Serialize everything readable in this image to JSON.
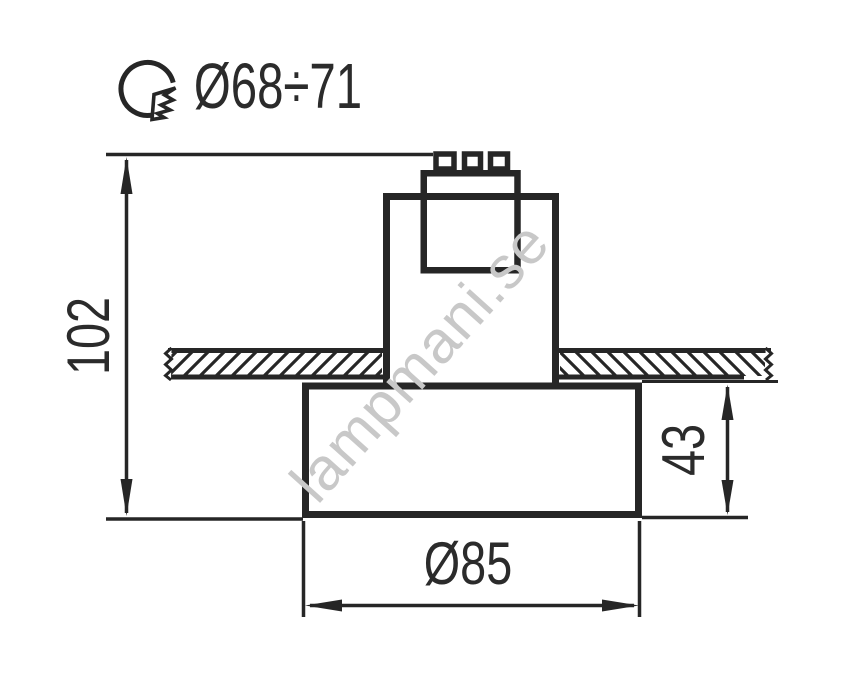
{
  "drawing": {
    "hole_diameter_label": "Ø68÷71",
    "overall_height_label": "102",
    "trim_height_label": "43",
    "body_diameter_label": "Ø85"
  },
  "watermark": {
    "text": "lampmani.se",
    "color": "#c8c8c8"
  },
  "colors": {
    "line": "#262626",
    "text": "#2b2b2b",
    "background": "#ffffff"
  },
  "icon": {
    "cutout_hole": "circle-with-jagged-cutout"
  }
}
